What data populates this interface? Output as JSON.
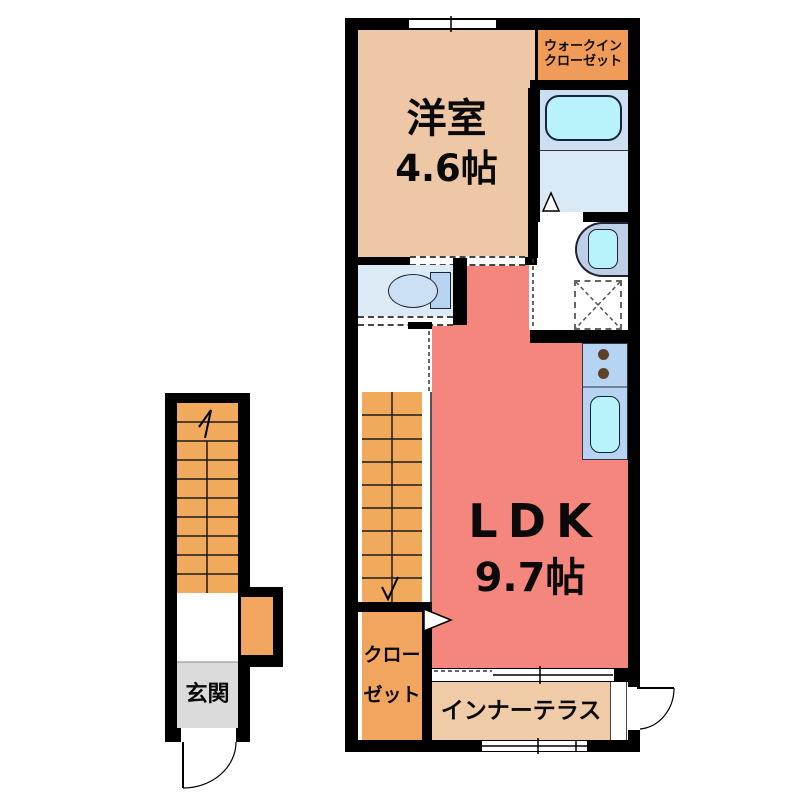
{
  "floorplan": {
    "rooms": {
      "western_room": {
        "name": "洋室",
        "size": "4.6帖"
      },
      "walk_in_closet": {
        "line1": "ウォークイン",
        "line2": "クローゼット"
      },
      "ldk": {
        "name": "LDK",
        "size": "9.7帖"
      },
      "closet": {
        "line1": "クロー",
        "line2": "ゼット"
      },
      "inner_terrace": {
        "name": "インナーテラス"
      },
      "entrance": {
        "name": "玄関"
      }
    },
    "colors": {
      "wall": "#000000",
      "western_room": "#EDC7A6",
      "walk_in_closet": "#F09C58",
      "stairs": "#F1A95C",
      "closet": "#F1A55E",
      "ldk": "#F5867E",
      "inner_terrace": "#EFCBA8",
      "entrance": "#DBDBDB",
      "bathroom_upper": "#CBDFF1",
      "bathroom_floor": "#D9E9F6",
      "toilet_room": "#DCEAF6",
      "fixture_fill": "#B7D4F0",
      "toilet_bowl": "#CBE0F4",
      "tub_fill": "#B8F3FB",
      "counter": "#B6D4F2",
      "vanity": "#BDD0E8",
      "burner": "#5E4228"
    }
  }
}
